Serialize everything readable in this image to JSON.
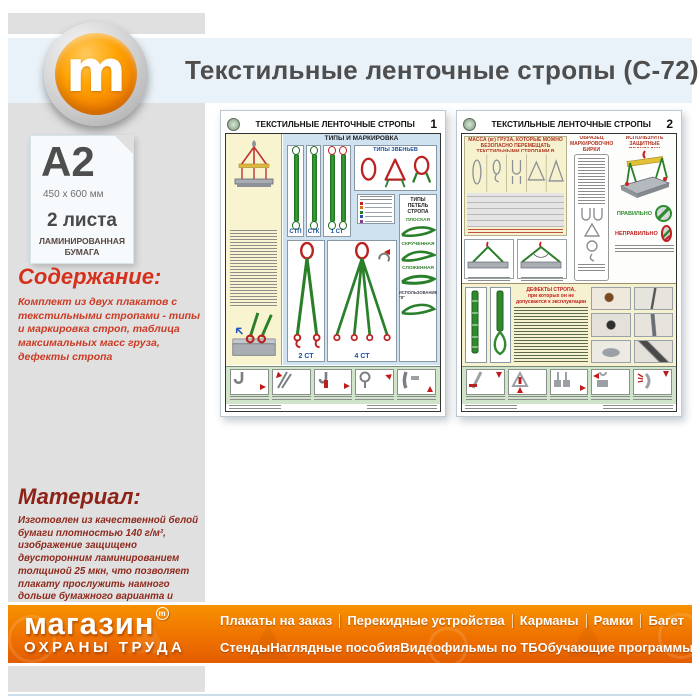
{
  "colors": {
    "brand_orange": "#ef7200",
    "header_band": "#e9f2f8",
    "sidebar_gray": "#e0e0e0",
    "content_red": "#d5301b",
    "material_maroon": "#8e2217",
    "poster_blue_bg": "#cfe2f0",
    "poster_yellow_bg": "#f6f2cf",
    "poster_green_band": "#cfe4c8",
    "strap_green": "#2a7f2a",
    "link_red": "#bb2222",
    "correct_green": "#2e8b2e",
    "incorrect_red": "#c02020"
  },
  "header": {
    "title": "Текстильные ленточные стропы (С-72)",
    "logo_letter": "m"
  },
  "sidebar": {
    "format": {
      "size": "A2",
      "dimensions": "450 x 600 мм",
      "sheets": "2 листа",
      "paper": "ЛАМИНИРОВАННАЯ БУМАГА"
    },
    "content": {
      "heading": "Содержание:",
      "text": "Комплект из двух плакатов с текстильными стропами - типы и маркировка строп, таблица максимальных масс груза, дефекты стропа"
    },
    "material": {
      "heading": "Материал:",
      "text": "Изготовлен из качественной белой бумаги плотностью 140 г/м², изображение защищено двусторонним ламинированием толщиной 25 мкн, что позволяет плакату прослужить намного дольше бумажного варианта и такой плакат не боится влаги - его смело можно протирать."
    }
  },
  "posters": {
    "p1": {
      "number": "1",
      "title": "ТЕКСТИЛЬНЫЕ ЛЕНТОЧНЫЕ СТРОПЫ",
      "types_heading": "ТИПЫ И МАРКИРОВКА",
      "links_heading": "ТИПЫ ЗВЕНЬЕВ",
      "loops_heading": "ТИПЫ ПЕТЕЛЬ СТРОПА",
      "labels": {
        "stp": "СТП",
        "stk": "СТК",
        "st1": "1 СТ",
        "st2": "2 СТ",
        "st4": "4 СТ"
      },
      "loops": {
        "flat": "ПЛОСКАЯ",
        "twisted": "СКРУЧЕННАЯ",
        "folded": "СЛОЖЕННАЯ",
        "use8": "ИСПОЛЬЗОВАНИЕ \"8\""
      }
    },
    "p2": {
      "number": "2",
      "title": "ТЕКСТИЛЬНЫЕ ЛЕНТОЧНЫЕ СТРОПЫ",
      "table_heading": "МАССА (кг) ГРУЗА, КОТОРЫЕ МОЖНО БЕЗОПАСНО ПЕРЕМЕЩАТЬ ТЕКСТИЛЬНЫМИ СТРОПАМИ В ЗАВИСИМОСТИ ОТ СПОСОБА СТРОПОВКИ",
      "tag_heading": "ОБРАЗЕЦ МАРКИРОВОЧНОЙ БИРКИ",
      "pads_heading": "ИСПОЛЬЗУЙТЕ ЗАЩИТНЫЕ ПОДКЛАДКИ",
      "correct": "ПРАВИЛЬНО",
      "incorrect": "НЕПРАВИЛЬНО",
      "defects_line1": "ДЕФЕКТЫ СТРОПА,",
      "defects_line2": "при которых он не допускается к эксплуатации"
    }
  },
  "footer": {
    "brand_line1": "магазин",
    "brand_mark": "m",
    "brand_line2": "ОХРАНЫ ТРУДА",
    "nav_row1": [
      "Плакаты на заказ",
      "Перекидные устройства",
      "Карманы",
      "Рамки",
      "Багет"
    ],
    "nav_row2": [
      "Стенды",
      "Наглядные пособия",
      "Видеофильмы по ТБ",
      "Обучающие программы"
    ]
  }
}
